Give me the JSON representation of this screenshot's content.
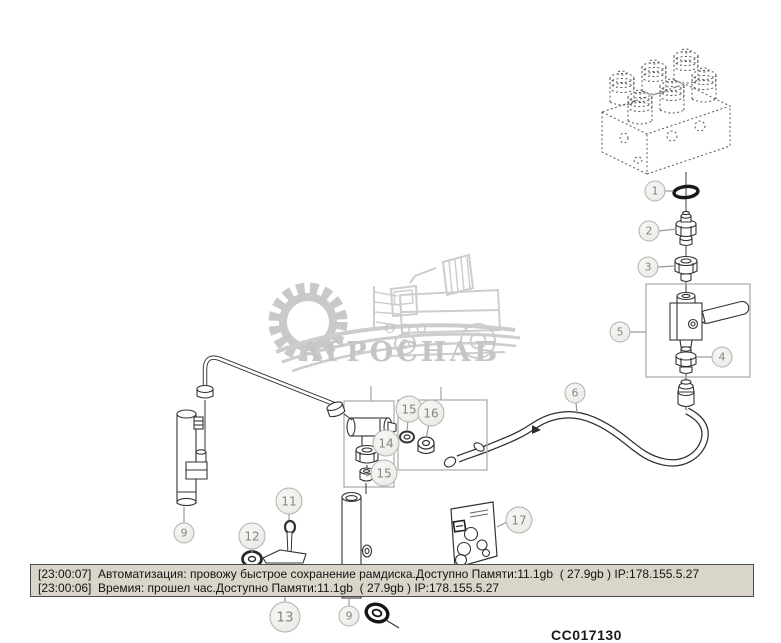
{
  "watermark": {
    "prefix": "ООО",
    "name": "АГРОСНАБ",
    "color": "#c5c5c5"
  },
  "status_bar": {
    "bg_color": "#d9d5c9",
    "lines": [
      "[23:00:07]  Автоматизация: провожу быстрое сохранение рамдиска.Доступно Памяти:11.1gb  ( 27.9gb ) IP:178.155.5.27",
      "[23:00:06]  Времия: прошел час.Доступно Памяти:11.1gb  ( 27.9gb ) IP:178.155.5.27"
    ]
  },
  "drawing_number": "CC017130",
  "callouts": {
    "n1": "1",
    "n2": "2",
    "n3": "3",
    "n4": "4",
    "n5": "5",
    "n6": "6",
    "n9": "9",
    "n11": "11",
    "n12": "12",
    "n13": "13",
    "n14": "14",
    "n15": "15",
    "n16": "16",
    "n17": "17"
  }
}
